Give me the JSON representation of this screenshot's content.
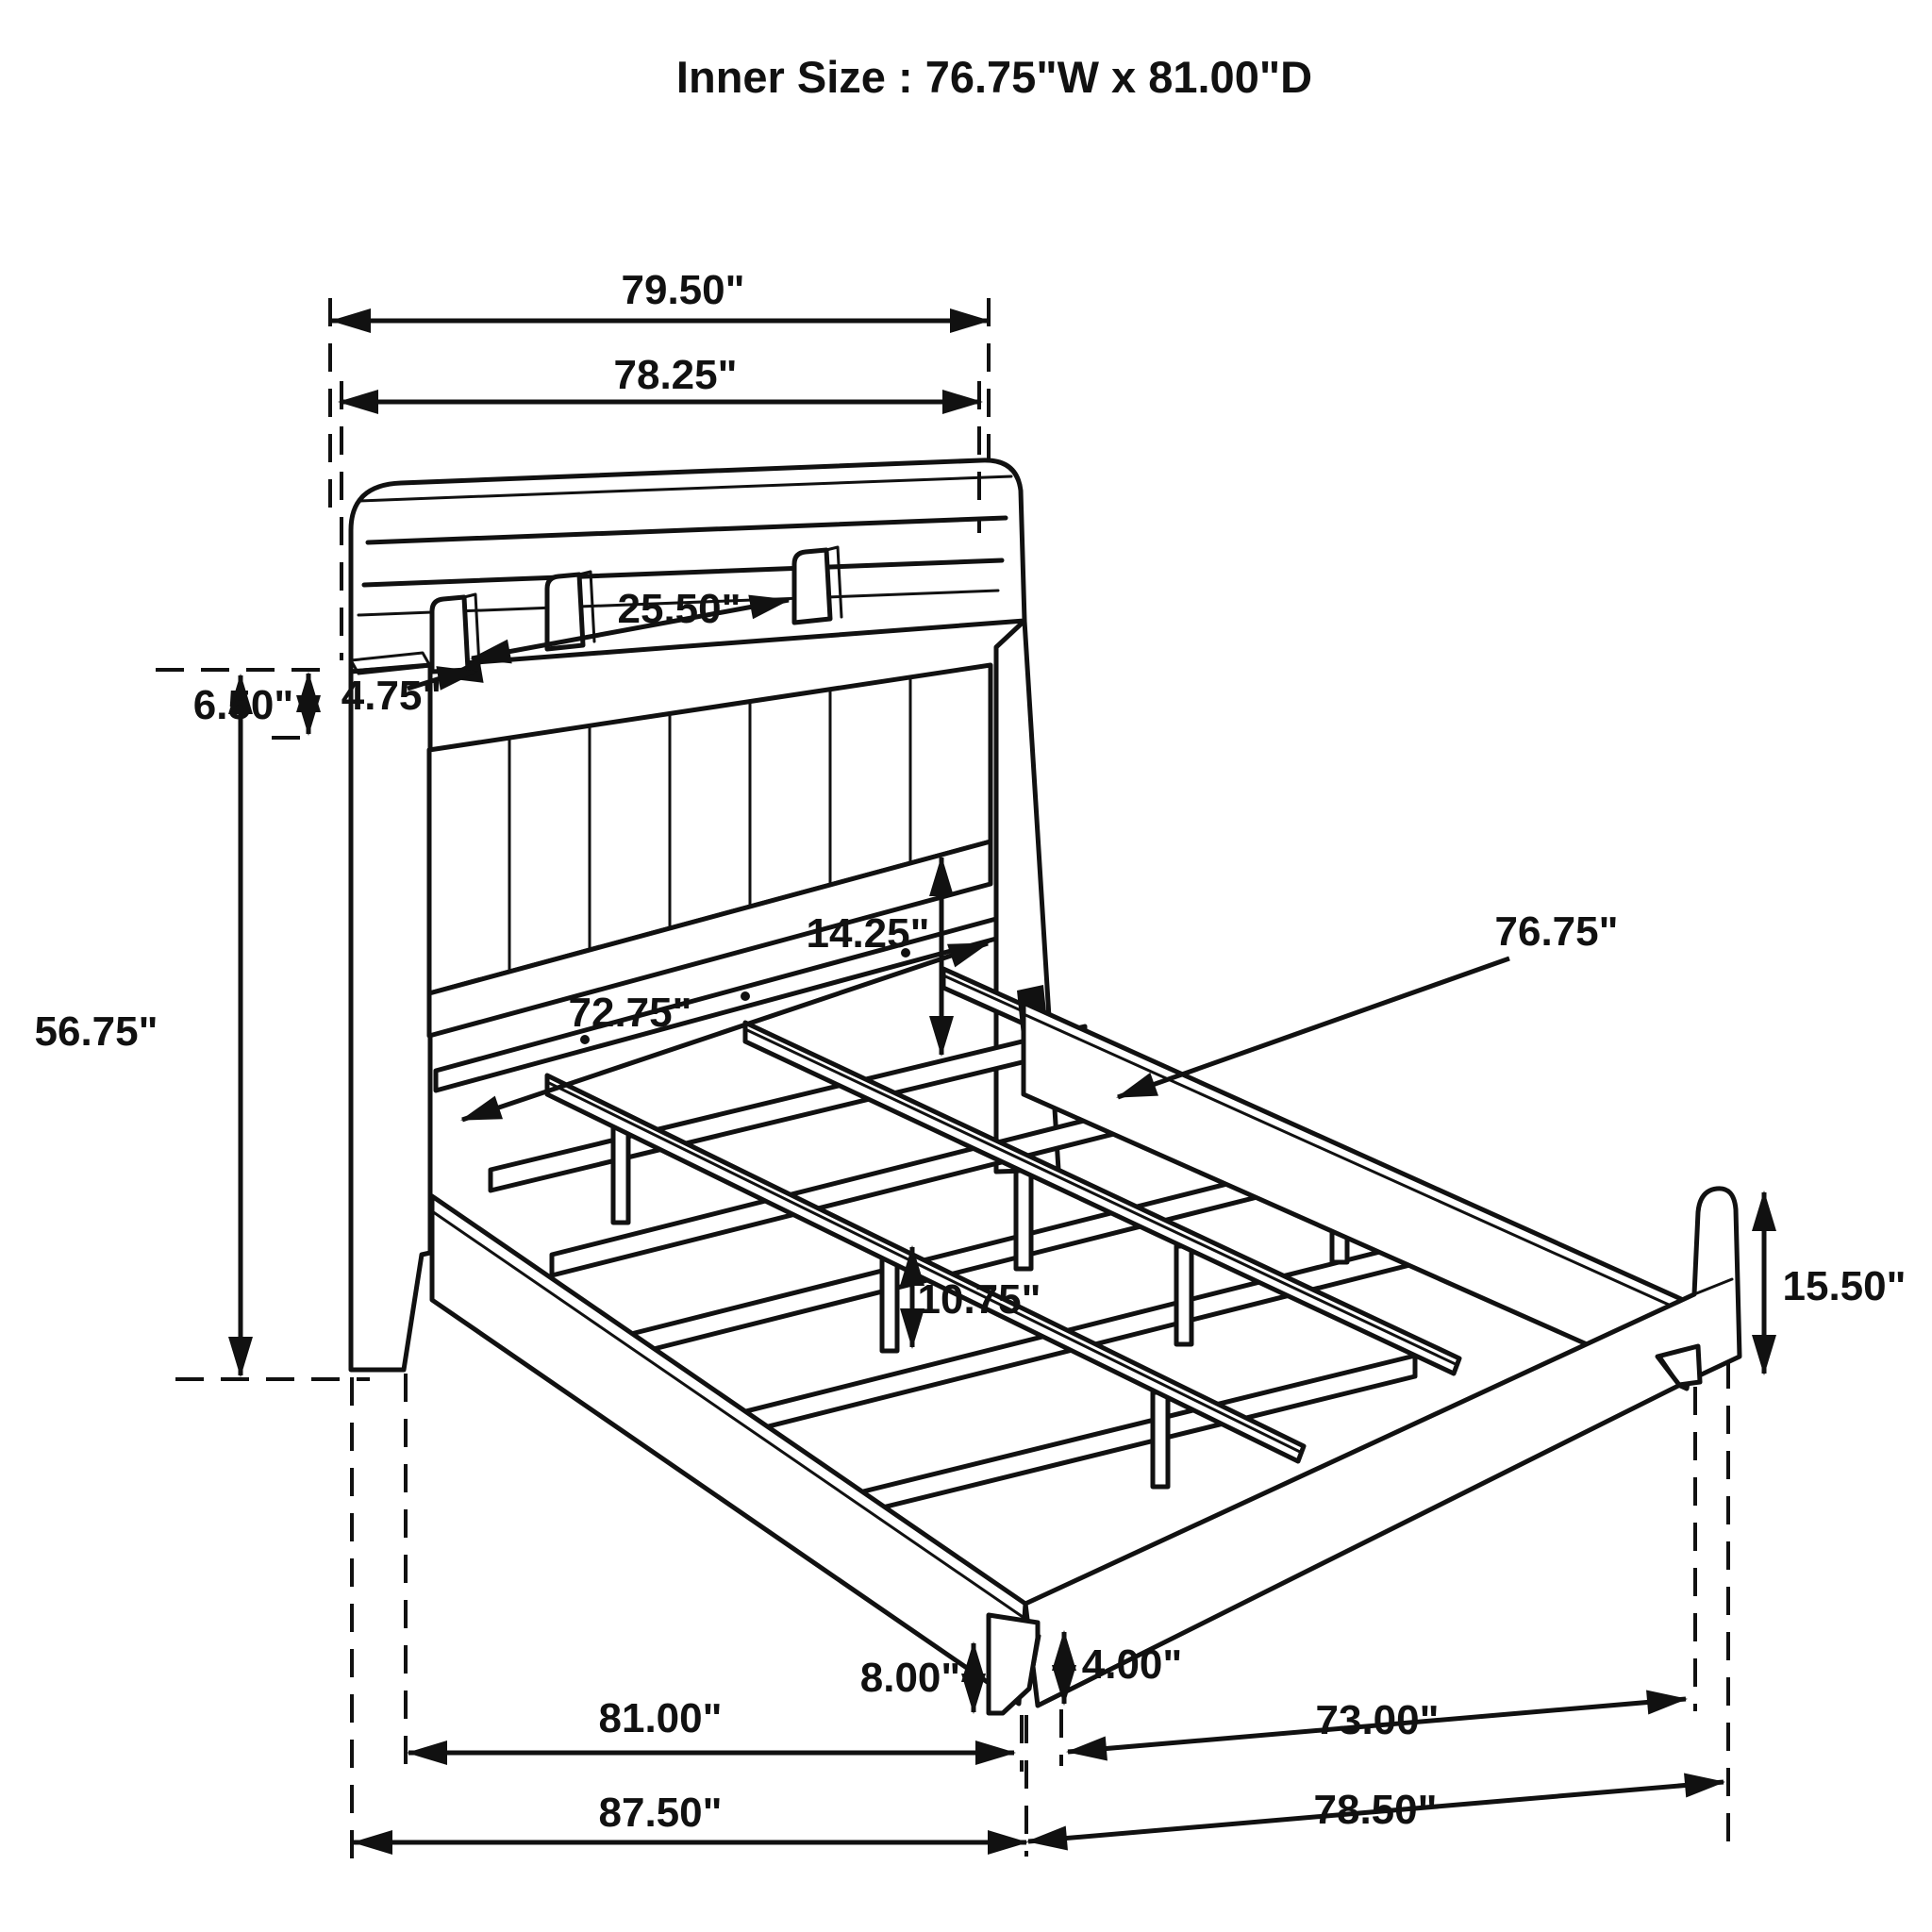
{
  "title": "Inner Size : 76.75\"W x 81.00\"D",
  "dims": {
    "width_overall": "79.50\"",
    "width_top": "78.25\"",
    "shelf_opening": "25.50\"",
    "divider_spacing": "4.75\"",
    "hutch_height": "6.50\"",
    "headboard_height": "56.75\"",
    "panel_drop": "14.25\"",
    "inner_width": "72.75\"",
    "rail_length": "76.75\"",
    "footboard_height": "15.50\"",
    "support_leg_height": "10.75\"",
    "front_leg_height": "8.00\"",
    "leg_taper": "4.00\"",
    "inner_depth": "81.00\"",
    "footboard_inner_width": "73.00\"",
    "overall_depth": "87.50\"",
    "side_rail_depth": "78.50\""
  }
}
